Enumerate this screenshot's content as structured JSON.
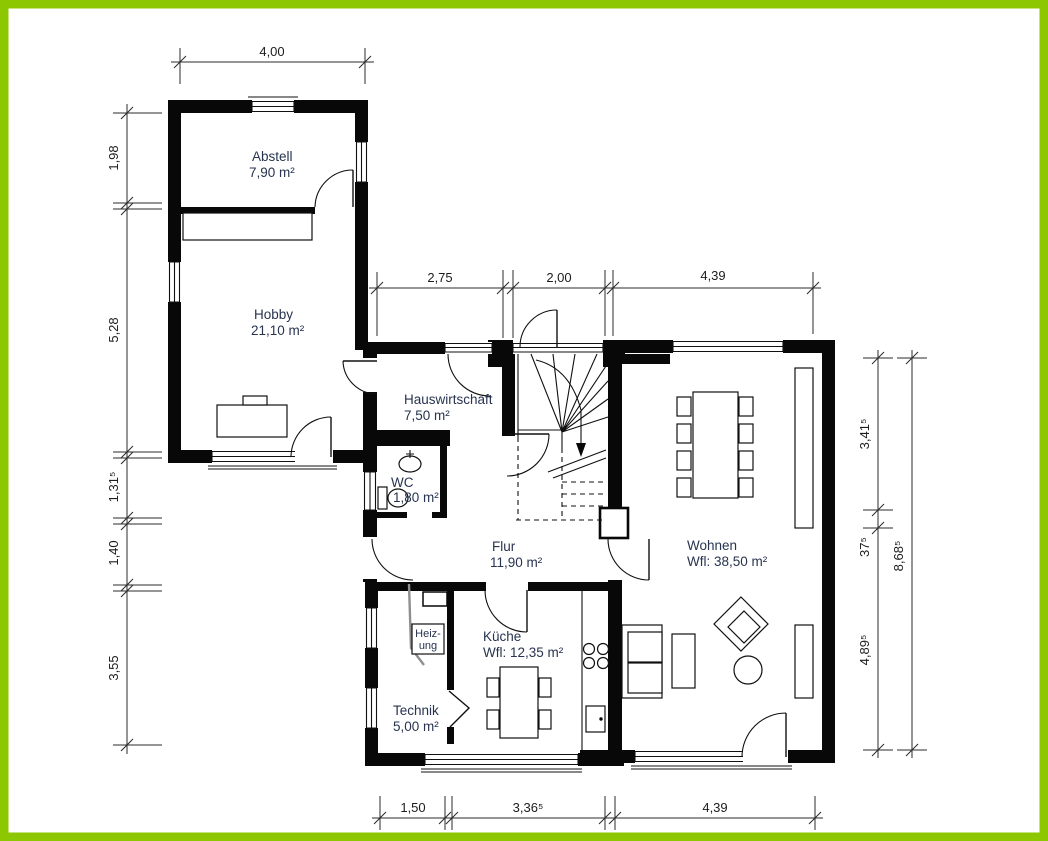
{
  "drawing": {
    "kind": "floor-plan",
    "frame_color": "#8cc702",
    "background": "#ffffff"
  },
  "rooms": {
    "abstell": {
      "name": "Abstell",
      "area": "7,90 m²"
    },
    "hobby": {
      "name": "Hobby",
      "area": "21,10 m²"
    },
    "hauswirtschaft": {
      "name": "Hauswirtschaft",
      "area": "7,50 m²"
    },
    "wc": {
      "name": "WC",
      "area": "1,80 m²"
    },
    "flur": {
      "name": "Flur",
      "area": "11,90 m²"
    },
    "wohnen": {
      "name": "Wohnen",
      "area": "Wfl: 38,50 m²"
    },
    "kueche": {
      "name": "Küche",
      "area": "Wfl: 12,35 m²"
    },
    "technik": {
      "name": "Technik",
      "area": "5,00 m²"
    },
    "heizung": {
      "line1": "Heiz-",
      "line2": "ung"
    }
  },
  "dimensions": {
    "top": "4,00",
    "upper": [
      "2,75",
      "2,00",
      "4,39"
    ],
    "left": [
      "1,98",
      "5,28",
      "1,31⁵",
      "1,40",
      "3,55"
    ],
    "right": [
      "3,41⁵",
      "37⁵",
      "4,89⁵"
    ],
    "right_total": "8,68⁵",
    "bottom": [
      "1,50",
      "3,36⁵",
      "4,39"
    ]
  }
}
